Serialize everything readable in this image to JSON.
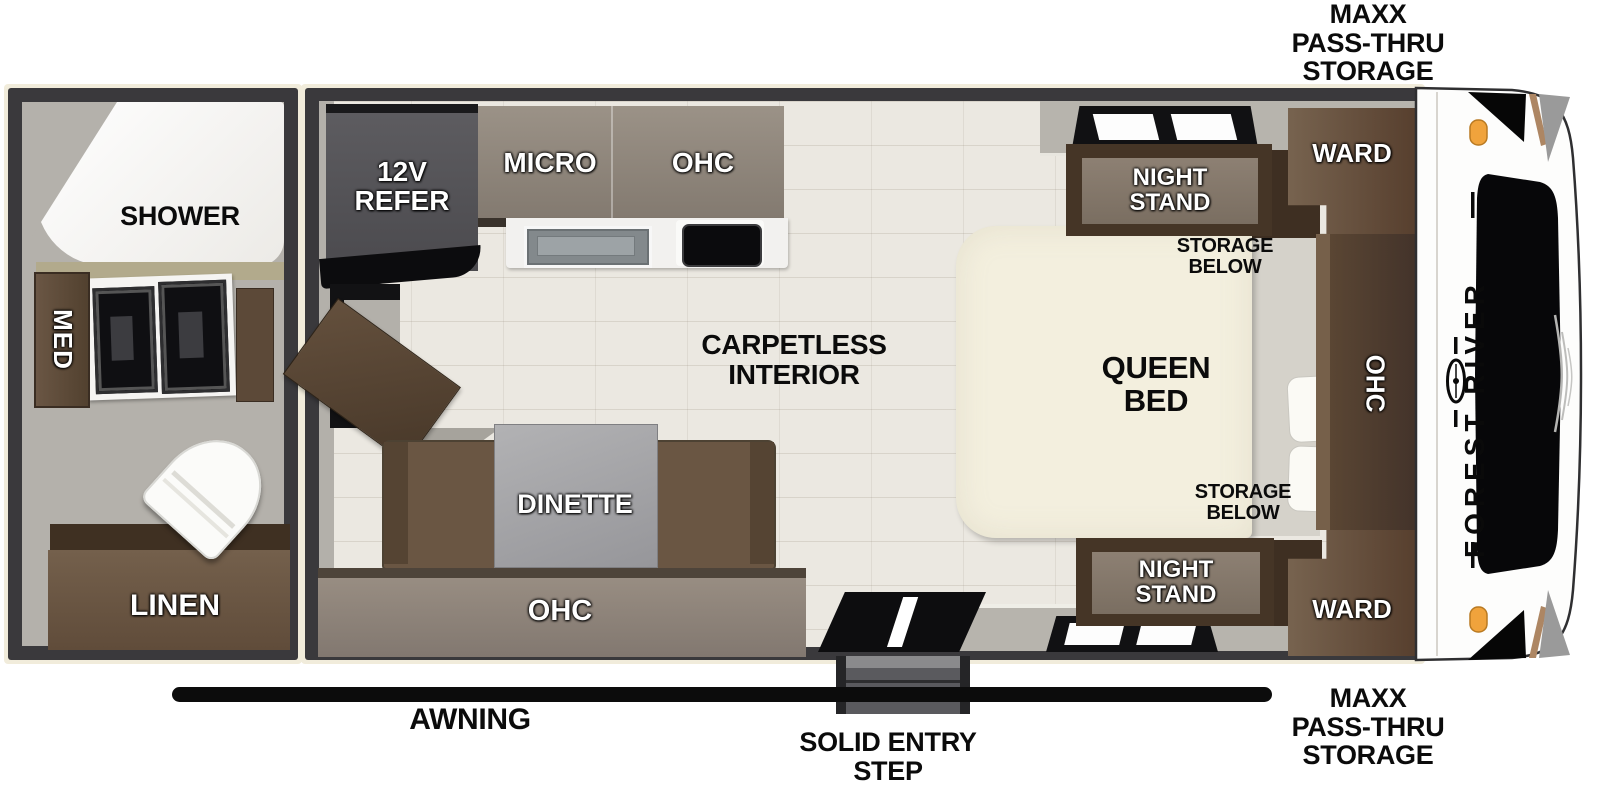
{
  "exterior": {
    "storage_label_top": "MAXX\nPASS-THRU\nSTORAGE",
    "storage_label_bottom": "MAXX\nPASS-THRU\nSTORAGE",
    "awning_label": "AWNING",
    "entry_step_label": "SOLID ENTRY\nSTEP",
    "brand": "FOREST RIVER"
  },
  "bathroom": {
    "shower_label": "SHOWER",
    "med_label": "MED",
    "linen_label": "LINEN"
  },
  "kitchen": {
    "refer_label": "12V\nREFER",
    "micro_label": "MICRO",
    "ohc_label": "OHC"
  },
  "living": {
    "floor_label": "CARPETLESS\nINTERIOR",
    "dinette_label": "DINETTE",
    "ohc_label": "OHC"
  },
  "bedroom": {
    "bed_label": "QUEEN\nBED",
    "storage_top_label": "STORAGE\nBELOW",
    "storage_bottom_label": "STORAGE\nBELOW",
    "nightstand_top_label": "NIGHT\nSTAND",
    "nightstand_bottom_label": "NIGHT\nSTAND",
    "ward_top_label": "WARD",
    "ward_bottom_label": "WARD",
    "ohc_label": "OHC"
  },
  "colors": {
    "wall": "#3a393c",
    "trim": "#f1ecdb",
    "floor": "#ebe8e1",
    "cabinet_dark": "#453526",
    "cabinet_brown": "#6a5543",
    "cabinet_taupe": "#8d8277",
    "bed": "#f3efde",
    "amber_light": "#f0a33c"
  }
}
